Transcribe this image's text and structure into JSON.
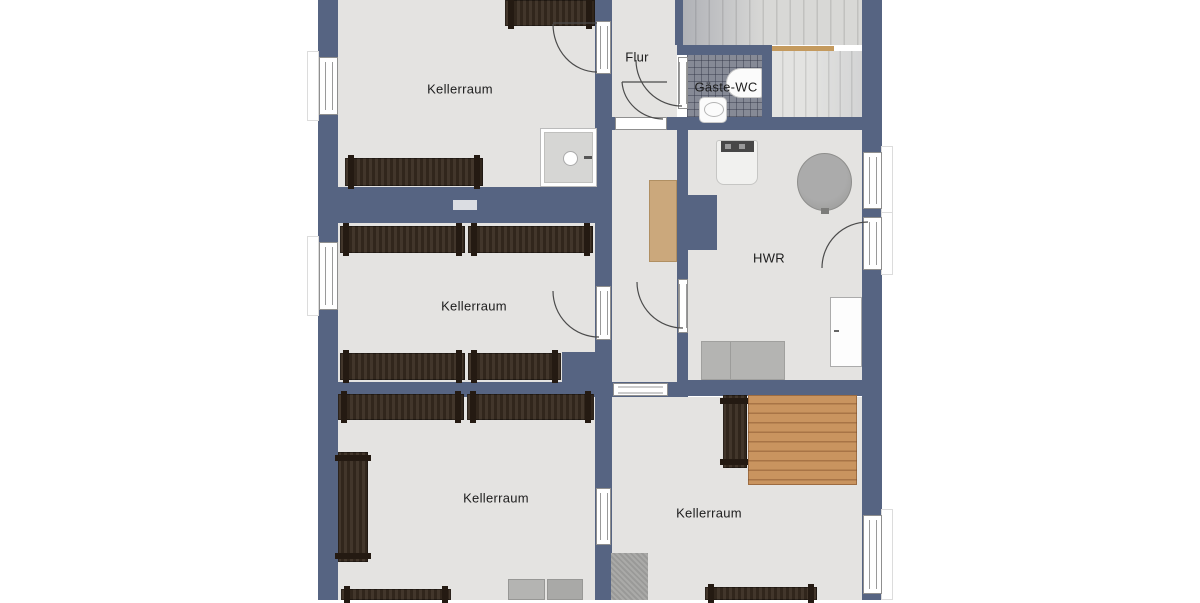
{
  "rooms": {
    "kellerraum_1": "Kellerraum",
    "kellerraum_2": "Kellerraum",
    "kellerraum_3": "Kellerraum",
    "kellerraum_4": "Kellerraum",
    "flur": "Flur",
    "gaeste_wc": "Gäste-WC",
    "hwr": "HWR"
  },
  "colors": {
    "wall": "#566482",
    "floor": "#e4e3e1",
    "shelf_dark_wood": "#382b20",
    "deck_wood": "#c9945f",
    "cabinet_tan": "#cba87c",
    "appliance_gray": "#b4b4b2",
    "background": "#ffffff"
  }
}
